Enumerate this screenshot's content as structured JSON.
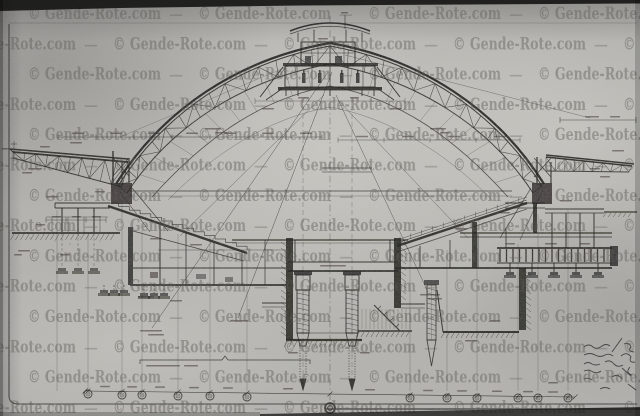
{
  "watermark": {
    "text": "© Gende-Rote.com",
    "separator": "—"
  },
  "colors": {
    "paper": "#b4b3af",
    "paper_light": "#d4d3cd",
    "paper_dark": "#8e8d8a",
    "ink": "#1d1c1a",
    "watermark": "#514e49",
    "photo_edge": "#141413"
  }
}
